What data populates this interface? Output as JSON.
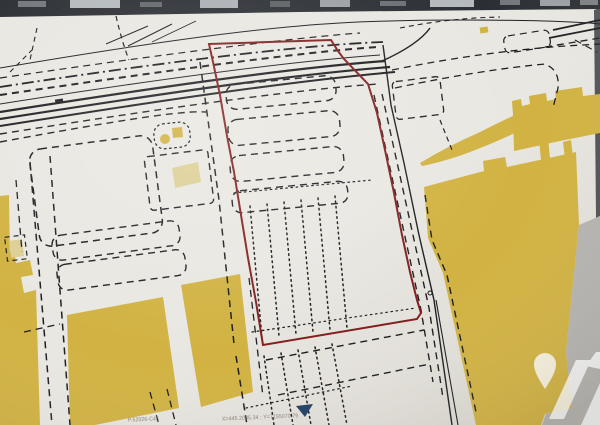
{
  "annotations": {
    "ref_text": "P.52026-C45",
    "coords_text": "X=445.2085.34 ; Y=7155070.79"
  },
  "icons": {
    "marker_triangle": "navy downward triangle map marker",
    "watermark_pin": "white map-pin watermark",
    "watermark_letter": "white stylized letter-A watermark"
  },
  "colors": {
    "paper": "#e9e7e1",
    "paper_dark": "#dbd8d1",
    "photo_dark": "#2b2e33",
    "photo_light": "#ccd1d5",
    "ink": "#1d1d20",
    "red": "#851d1d",
    "yellow": "#d2b23d",
    "yellow_pale": "#ddcf92",
    "gray_zone": "#b5b3af",
    "navy": "#1e3f66",
    "watermark": "#ffffff",
    "text": "#857f72"
  }
}
